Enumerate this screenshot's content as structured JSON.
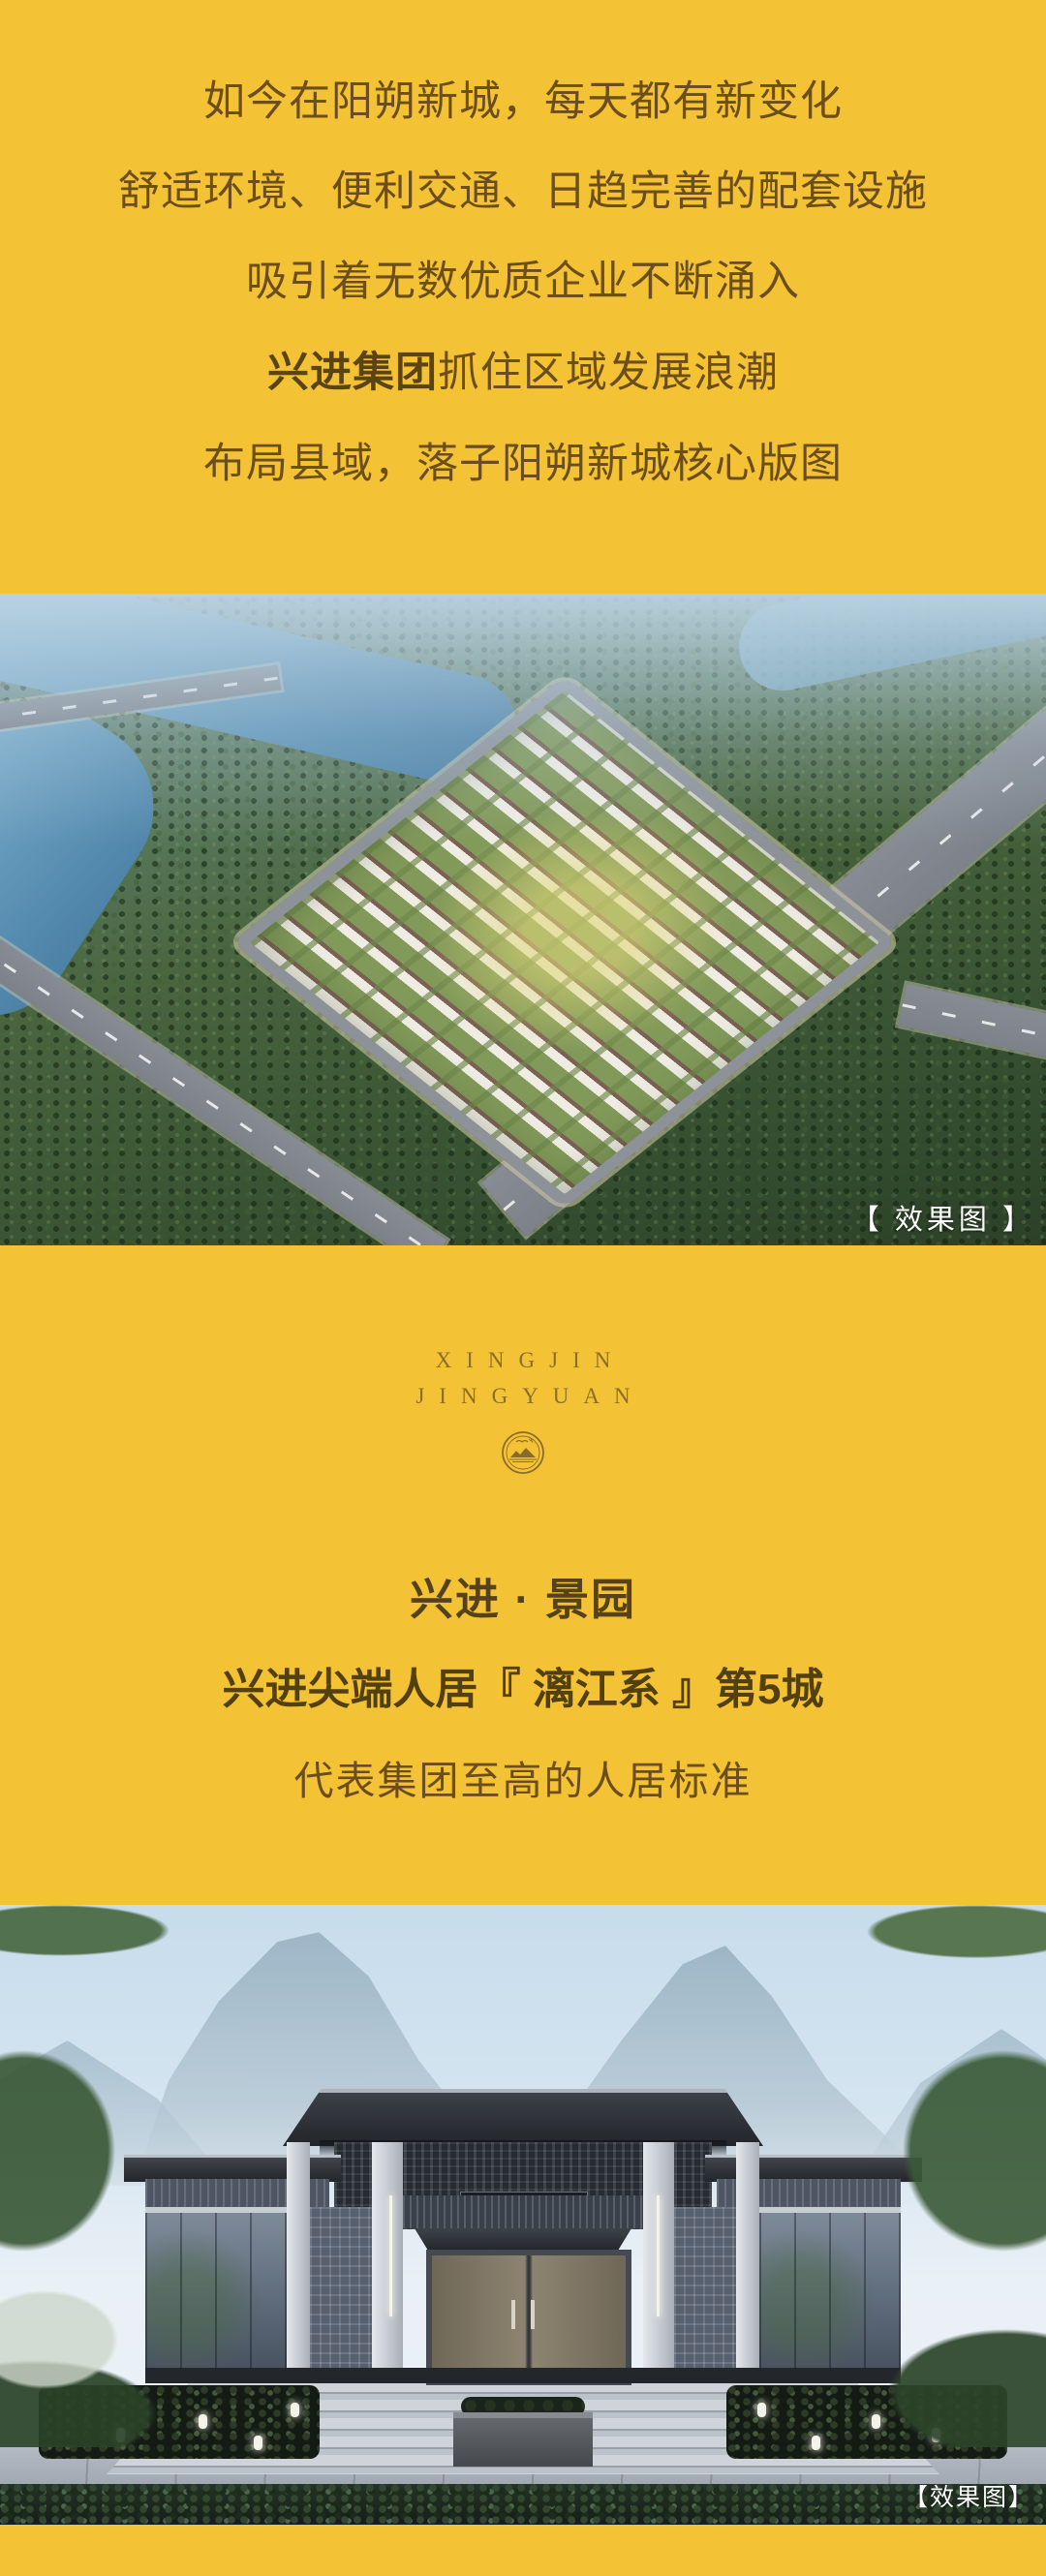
{
  "intro": {
    "lines": [
      "如今在阳朔新城，每天都有新变化",
      "舒适环境、便利交通、日趋完善的配套设施",
      "吸引着无数优质企业不断涌入"
    ],
    "line4": {
      "bold": "兴进集团",
      "rest": "抓住区域发展浪潮"
    },
    "line5": "布局县域，落子阳朔新城核心版图"
  },
  "aerial_render": {
    "caption": "【 效果图 】"
  },
  "brand": {
    "latin_line1": "XINGJIN",
    "latin_line2": "JINGYUAN",
    "seal_icon": "mountain-river-seal-icon",
    "title": "兴进 · 景园",
    "subtitle": "兴进尖端人居『 漓江系 』第5城",
    "tagline": "代表集团至高的人居标准"
  },
  "entrance_render": {
    "gate_plaque": "兴进 · 景园",
    "caption": "【效果图】"
  },
  "colors": {
    "accent_yellow": "#f4c235",
    "body_text_brown": "#6b4e1b",
    "headline_brown": "#53400f",
    "serif_gold": "#8c6d2c",
    "caption_white": "#ffffff"
  }
}
